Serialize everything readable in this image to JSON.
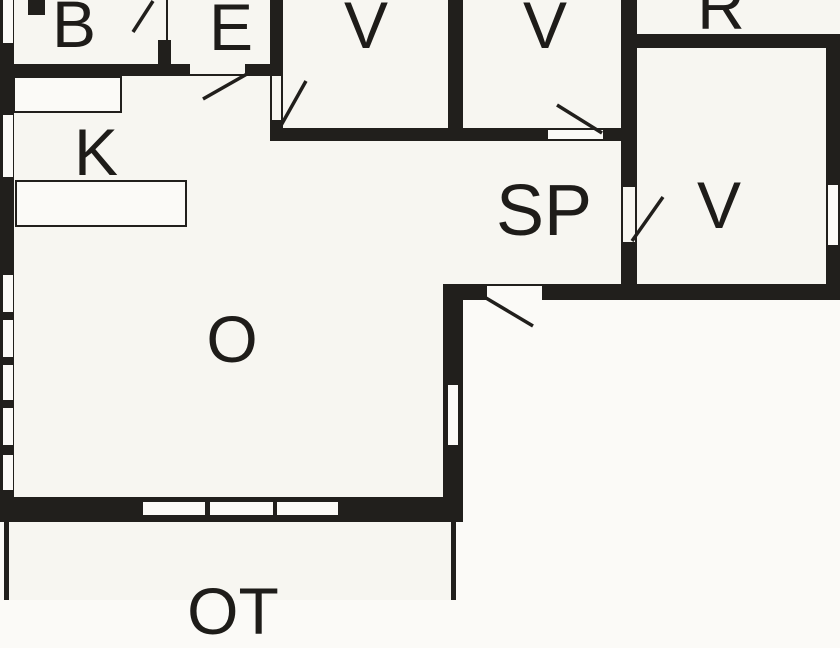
{
  "rooms": {
    "b": "B",
    "e": "E",
    "v1": "V",
    "v2": "V",
    "r": "R",
    "k": "K",
    "sp": "SP",
    "v3": "V",
    "o": "O",
    "ot": "OT"
  },
  "colors": {
    "wall": "#211f1c",
    "paper": "#fbfaf7",
    "floor": "#f7f6f1",
    "label": "#1e1c19"
  }
}
